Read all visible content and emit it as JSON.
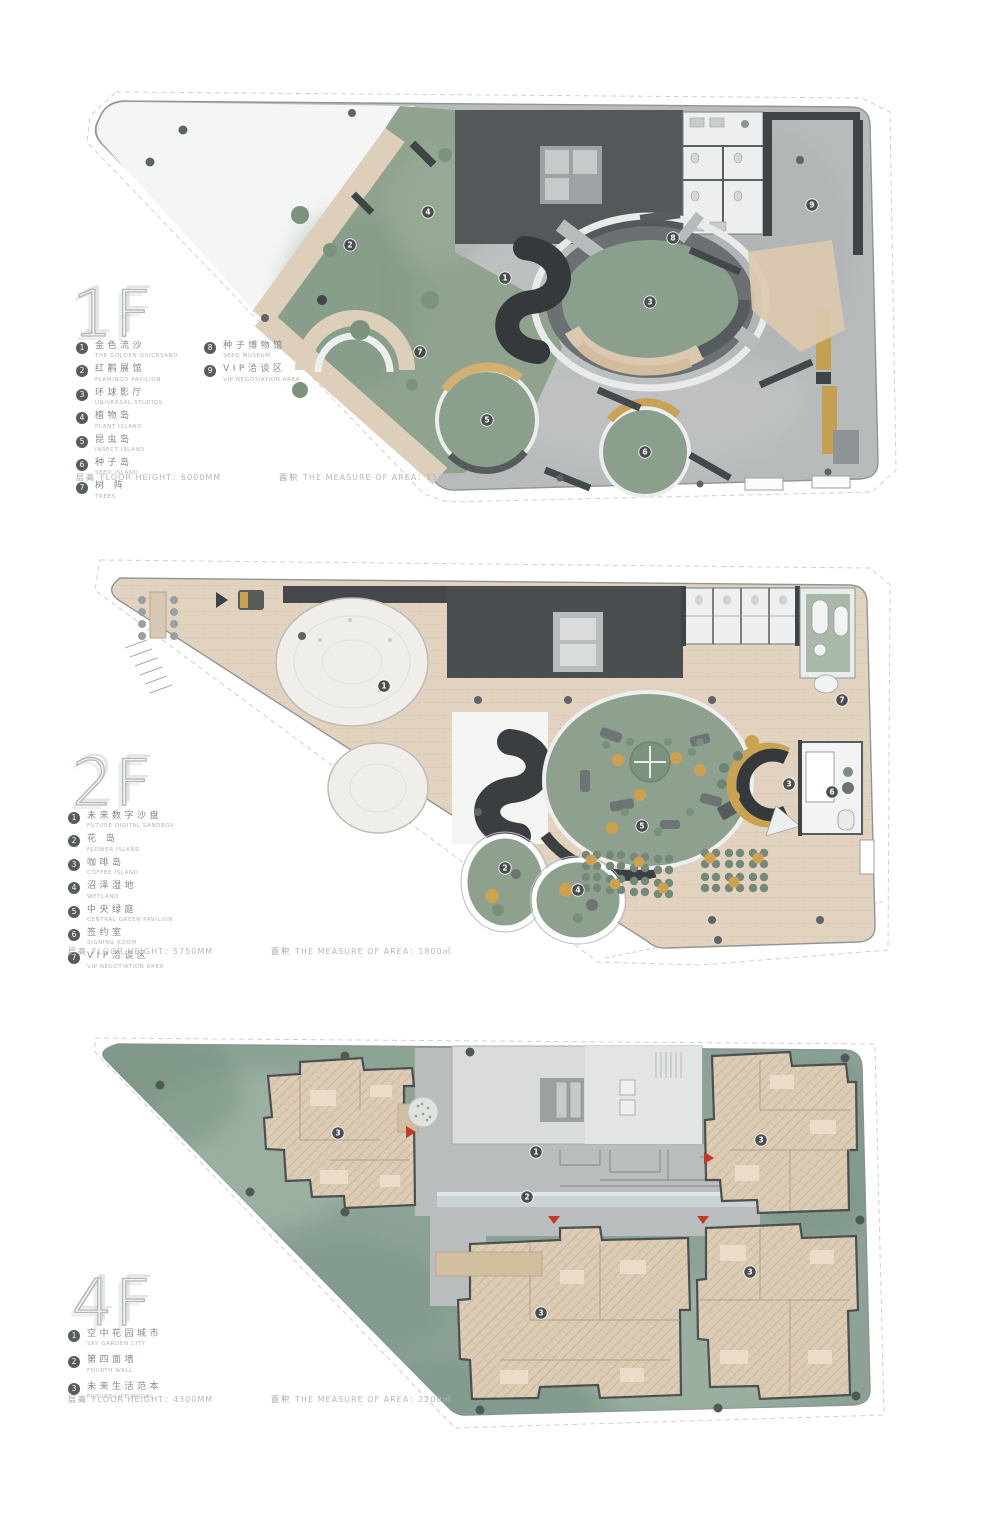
{
  "colors": {
    "concrete": "#b8bbbc",
    "sage": "#8fa38f",
    "wood": "#e2d3c0",
    "dark_core": "#4e5254",
    "charcoal": "#35393b",
    "gold": "#c8a452",
    "garden_green": "#8ba295",
    "marker": "#4a4f51"
  },
  "floors": [
    {
      "id": "f1",
      "title": "1F",
      "legend": [
        {
          "num": "1",
          "zh": "金色流沙",
          "en": "THE GOLDEN QUICKSAND"
        },
        {
          "num": "2",
          "zh": "红鹳展馆",
          "en": "FLAMINGO PAVILION"
        },
        {
          "num": "3",
          "zh": "环球影厅",
          "en": "UNIVERSAL STUDIOS"
        },
        {
          "num": "4",
          "zh": "植物岛",
          "en": "PLANT ISLAND"
        },
        {
          "num": "5",
          "zh": "昆虫岛",
          "en": "INSECT ISLAND"
        },
        {
          "num": "6",
          "zh": "种子岛",
          "en": "SEED ISLAND"
        },
        {
          "num": "7",
          "zh": "树 阵",
          "en": "TREES"
        },
        {
          "num": "8",
          "zh": "种子博物馆",
          "en": "SEED MUSEUM"
        },
        {
          "num": "9",
          "zh": "VIP洽谈区",
          "en": "VIP NEGOTIATION AREA"
        }
      ],
      "footer": {
        "zh1": "层高",
        "t1": "FLOOR HEIGHT：6000MM",
        "zh2": "面积",
        "t2": "THE MEASURE OF AREA：1500㎡"
      },
      "markers": [
        {
          "x": 505,
          "y": 278,
          "n": "1"
        },
        {
          "x": 350,
          "y": 245,
          "n": "2"
        },
        {
          "x": 650,
          "y": 302,
          "n": "3"
        },
        {
          "x": 428,
          "y": 212,
          "n": "4"
        },
        {
          "x": 487,
          "y": 420,
          "n": "5"
        },
        {
          "x": 645,
          "y": 452,
          "n": "6"
        },
        {
          "x": 420,
          "y": 352,
          "n": "7"
        },
        {
          "x": 673,
          "y": 238,
          "n": "8"
        },
        {
          "x": 812,
          "y": 205,
          "n": "9"
        }
      ]
    },
    {
      "id": "f2",
      "title": "2F",
      "legend": [
        {
          "num": "1",
          "zh": "未来数字沙盘",
          "en": "FUTURE DIGITAL SANDBOX"
        },
        {
          "num": "2",
          "zh": "花 岛",
          "en": "FLOWER ISLAND"
        },
        {
          "num": "3",
          "zh": "咖啡岛",
          "en": "COFFEE ISLAND"
        },
        {
          "num": "4",
          "zh": "沼泽湿地",
          "en": "WETLAND"
        },
        {
          "num": "5",
          "zh": "中央绿庭",
          "en": "CENTRAL GREEN PAVILION"
        },
        {
          "num": "6",
          "zh": "签约室",
          "en": "SIGNING ROOM"
        },
        {
          "num": "7",
          "zh": "VIP洽谈区",
          "en": "VIP NEGOTIATION AREA"
        }
      ],
      "footer": {
        "zh1": "层高",
        "t1": "FLOOR HEIGHT：5750MM",
        "zh2": "面积",
        "t2": "THE MEASURE OF AREA：1800㎡"
      },
      "markers": [
        {
          "x": 384,
          "y": 686,
          "n": "1"
        },
        {
          "x": 505,
          "y": 868,
          "n": "2"
        },
        {
          "x": 789,
          "y": 784,
          "n": "3"
        },
        {
          "x": 578,
          "y": 890,
          "n": "4"
        },
        {
          "x": 642,
          "y": 826,
          "n": "5"
        },
        {
          "x": 832,
          "y": 792,
          "n": "6"
        },
        {
          "x": 842,
          "y": 700,
          "n": "7"
        }
      ]
    },
    {
      "id": "f4",
      "title": "4F",
      "legend": [
        {
          "num": "1",
          "zh": "空中花园城市",
          "en": "SKY GARDEN CITY"
        },
        {
          "num": "2",
          "zh": "第四面墙",
          "en": "FOURTH WALL"
        },
        {
          "num": "3",
          "zh": "未来生活范本",
          "en": "FUTURE LIFE MODEL"
        }
      ],
      "footer": {
        "zh1": "层高",
        "t1": "FLOOR HEIGHT：4300MM",
        "zh2": "面积",
        "t2": "THE MEASURE OF AREA：2200㎡"
      },
      "markers": [
        {
          "x": 536,
          "y": 1152,
          "n": "1"
        },
        {
          "x": 527,
          "y": 1197,
          "n": "2"
        },
        {
          "x": 338,
          "y": 1133,
          "n": "3"
        },
        {
          "x": 761,
          "y": 1140,
          "n": "3"
        },
        {
          "x": 541,
          "y": 1313,
          "n": "3"
        },
        {
          "x": 750,
          "y": 1272,
          "n": "3"
        }
      ]
    }
  ]
}
